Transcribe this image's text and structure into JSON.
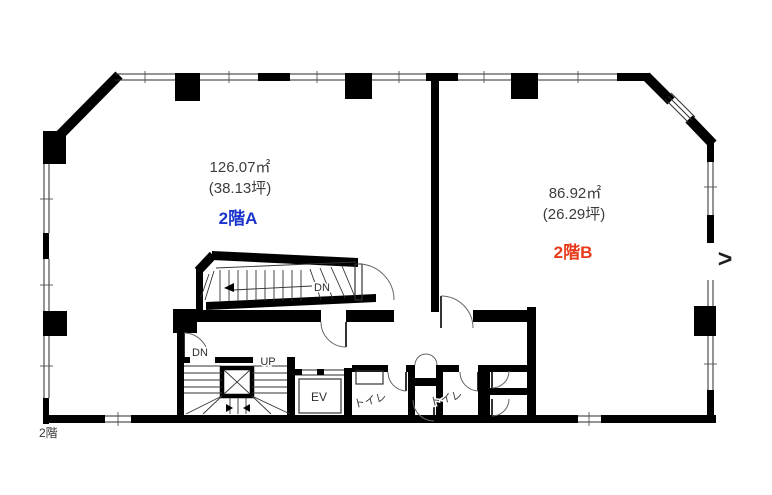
{
  "colors": {
    "wall": "#000000",
    "unit_a_label": "#1a34cc",
    "unit_b_label": "#e8391b",
    "measure_text": "#3c3c3c",
    "background": "#ffffff"
  },
  "floor_plan": {
    "floor_label": "2階",
    "units": [
      {
        "name": "2階A",
        "area_m2": "126.07㎡",
        "area_tsubo": "(38.13坪)"
      },
      {
        "name": "2階B",
        "area_m2": "86.92㎡",
        "area_tsubo": "(26.29坪)"
      }
    ],
    "stairs": {
      "upper_down_label": "DN",
      "core_down_label": "DN",
      "core_up_label": "UP"
    },
    "elevator_label": "EV",
    "toilet_labels": [
      "トイレ",
      "トイレ"
    ]
  },
  "carousel": {
    "next_label": ">"
  }
}
